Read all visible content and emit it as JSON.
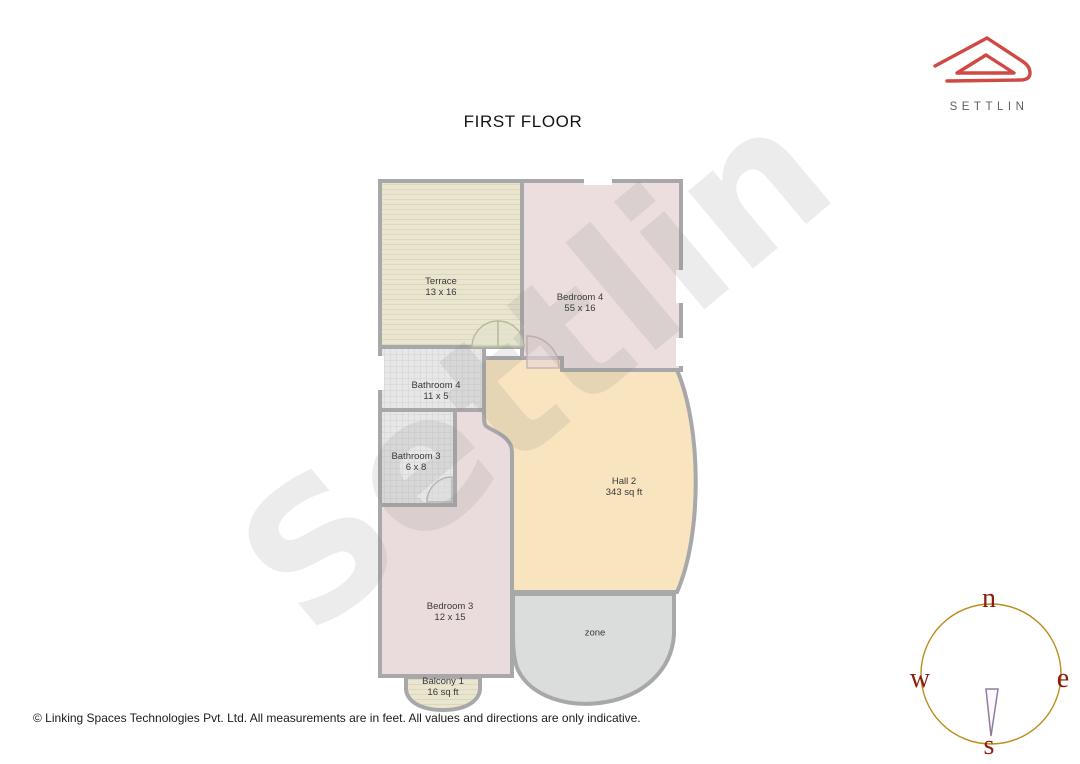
{
  "title": "FIRST FLOOR",
  "brand": {
    "name": "SETTLIN"
  },
  "watermark": "Settlin",
  "rooms": {
    "terrace": {
      "name": "Terrace",
      "dims": "13 x 16"
    },
    "bedroom4": {
      "name": "Bedroom 4",
      "dims": "55 x 16"
    },
    "bathroom4": {
      "name": "Bathroom 4",
      "dims": "11 x 5"
    },
    "bathroom3": {
      "name": "Bathroom 3",
      "dims": "6 x 8"
    },
    "hall2": {
      "name": "Hall 2",
      "dims": "343 sq ft"
    },
    "bedroom3": {
      "name": "Bedroom 3",
      "dims": "12 x 15"
    },
    "zone": {
      "name": "zone",
      "dims": ""
    },
    "balcony1": {
      "name": "Balcony 1",
      "dims": "16 sq ft"
    }
  },
  "compass": {
    "north": "n",
    "east": "e",
    "south": "s",
    "west": "w"
  },
  "footer": "© Linking Spaces Technologies Pvt. Ltd. All measurements are in feet. All values and directions are only indicative.",
  "colors": {
    "terrace_fill": "#eae5cf",
    "terrace_stripe": "#ddd7bc",
    "bedroom4_fill": "#ecdede",
    "bedroom3_fill": "#eadcdc",
    "bathroom_fill": "#e7e7e7",
    "tile_line": "#d2d2d2",
    "hall_fill": "#f8e4bf",
    "zone_fill": "#dadddb",
    "balcony_fill": "#ece6cd",
    "wall": "#a8a8aa",
    "logo_red": "#cf4a44",
    "logo_text": "#5d6167",
    "compass_circle": "#ba8e1c",
    "compass_letters": "#8e1b10",
    "needle_stroke": "#8f7da0"
  }
}
